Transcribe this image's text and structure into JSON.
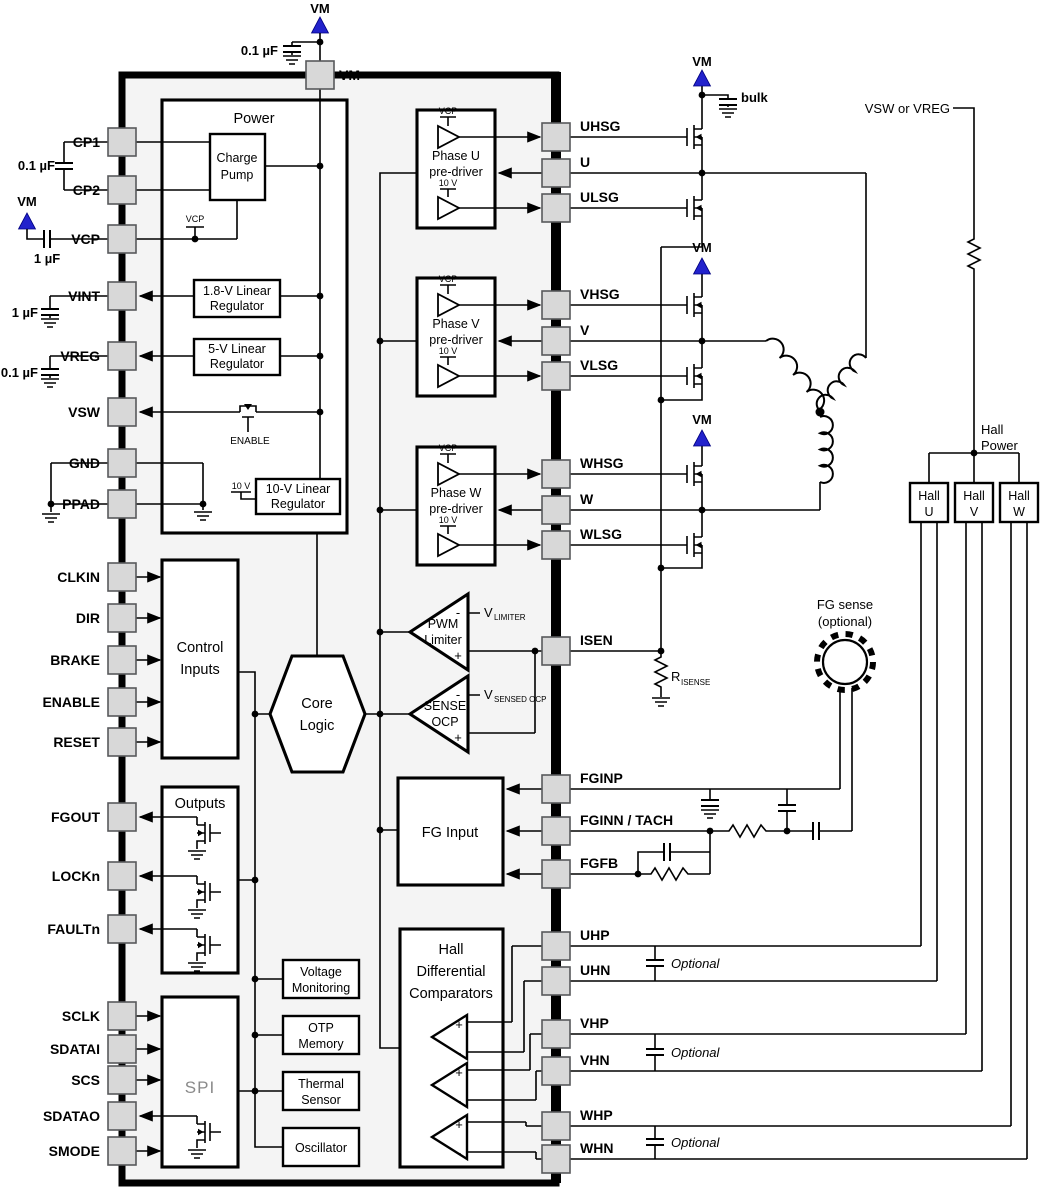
{
  "colors": {
    "chip_fill": "#f4f4f4",
    "pin_fill": "#d8d8d8",
    "wire": "#000000",
    "vm_arrow_blue": "#2222cc",
    "spi_text": "#8a8a8a"
  },
  "pins": {
    "top": "VM",
    "left": [
      "CP1",
      "CP2",
      "VCP",
      "VINT",
      "VREG",
      "VSW",
      "GND",
      "PPAD",
      "CLKIN",
      "DIR",
      "BRAKE",
      "ENABLE",
      "RESET",
      "FGOUT",
      "LOCKn",
      "FAULTn",
      "SCLK",
      "SDATAI",
      "SCS",
      "SDATAO",
      "SMODE"
    ],
    "right": [
      "UHSG",
      "U",
      "ULSG",
      "VHSG",
      "V",
      "VLSG",
      "WHSG",
      "W",
      "WLSG",
      "ISEN",
      "FGINP",
      "FGINN / TACH",
      "FGFB",
      "UHP",
      "UHN",
      "VHP",
      "VHN",
      "WHP",
      "WHN"
    ]
  },
  "power": {
    "title": "Power",
    "charge_pump": [
      "Charge",
      "Pump"
    ],
    "reg18": [
      "1.8-V Linear",
      "Regulator"
    ],
    "reg5": [
      "5-V Linear",
      "Regulator"
    ],
    "reg10": [
      "10-V Linear",
      "Regulator"
    ],
    "vcp_node": "VCP",
    "v10_node": "10 V",
    "enable": "ENABLE"
  },
  "predrivers": {
    "u": [
      "Phase U",
      "pre-driver"
    ],
    "v": [
      "Phase V",
      "pre-driver"
    ],
    "w": [
      "Phase W",
      "pre-driver"
    ],
    "vcp": "VCP",
    "v10": "10 V"
  },
  "core": {
    "control": [
      "Control",
      "Inputs"
    ],
    "logic": [
      "Core",
      "Logic"
    ],
    "pwm": [
      "PWM",
      "Limiter"
    ],
    "ocp": [
      "SENSE",
      "OCP"
    ],
    "v_limiter": [
      "V",
      "LIMITER"
    ],
    "v_sensed": [
      "V",
      "SENSED OCP"
    ],
    "plus": "+",
    "minus": "-"
  },
  "io": {
    "outputs": "Outputs",
    "spi": "SPI",
    "vmon": [
      "Voltage",
      "Monitoring"
    ],
    "otp": [
      "OTP",
      "Memory"
    ],
    "thermal": [
      "Thermal",
      "Sensor"
    ],
    "osc": "Oscillator",
    "fg": "FG Input",
    "hallcomp": [
      "Hall",
      "Differential",
      "Comparators"
    ]
  },
  "external": {
    "vm": "VM",
    "bulk": "bulk",
    "cap_01": "0.1 µF",
    "cap_1": "1 µF",
    "vsw_or_vreg": "VSW or VREG",
    "hall_power": [
      "Hall",
      "Power"
    ],
    "hall_u": [
      "Hall",
      "U"
    ],
    "hall_v": [
      "Hall",
      "V"
    ],
    "hall_w": [
      "Hall",
      "W"
    ],
    "fg_sense": [
      "FG sense",
      "(optional)"
    ],
    "optional": "Optional",
    "r_isense": [
      "R",
      "ISENSE"
    ]
  }
}
